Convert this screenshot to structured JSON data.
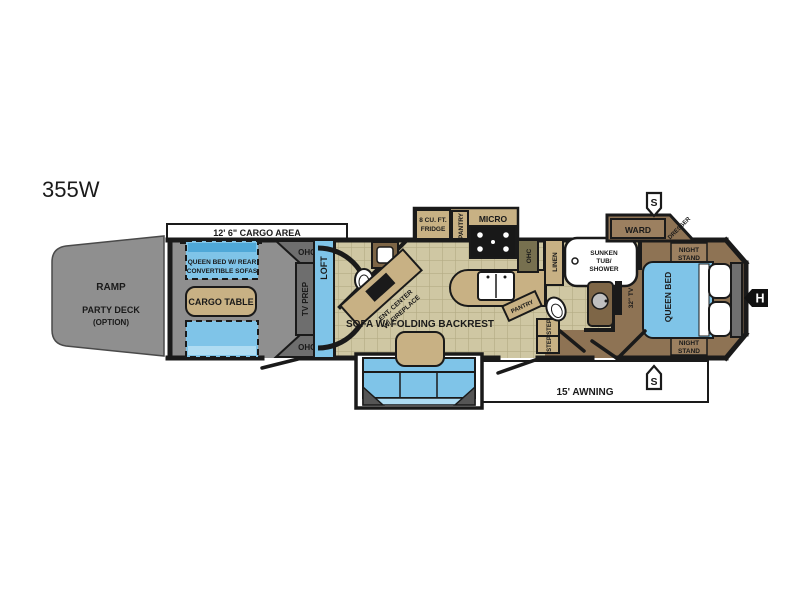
{
  "title": "355W",
  "markers": {
    "slide": "S",
    "hitch": "H"
  },
  "exterior": {
    "cargo_area": "12' 6\" CARGO AREA",
    "awning": "15' AWNING",
    "ramp": "RAMP",
    "party_deck": "PARTY DECK",
    "party_deck_option": "(OPTION)"
  },
  "garage": {
    "bed_line1": "QUEEN BED W/ REAR",
    "bed_line2": "CONVERTIBLE SOFAS",
    "cargo_table": "CARGO TABLE",
    "ohc": "OHC",
    "tv_prep": "TV PREP",
    "loft": "LOFT"
  },
  "living": {
    "ent_line1": "ENT. CENTER",
    "ent_line2": "W/ FIREPLACE",
    "sofa": "SOFA W/ FOLDING BACKREST",
    "fridge_line1": "8 CU. FT.",
    "fridge_line2": "FRIDGE",
    "pantry": "PANTRY",
    "micro": "MICRO",
    "ohc": "OHC",
    "step": "STEP"
  },
  "bath": {
    "linen": "LINEN",
    "tub_line1": "SUNKEN",
    "tub_line2": "TUB/",
    "tub_line3": "SHOWER"
  },
  "bedroom": {
    "ward": "WARD",
    "dresser": "DRESSER",
    "night_stand_line1": "NIGHT",
    "night_stand_line2": "STAND",
    "queen_bed": "QUEEN BED",
    "tv": "32\" TV"
  },
  "colors": {
    "outline": "#1a1a1a",
    "floor_tile": "#CFC7A3",
    "tile_grid": "#B4AB84",
    "floor_brown": "#8E7354",
    "floor_gray": "#8F8F8F",
    "cabinet_tan": "#C8B184",
    "wood_brown": "#7E6647",
    "furniture_blue": "#7FC4E8",
    "furniture_blue_dark": "#4FA8D8",
    "furniture_blue_light": "#AFDCF2",
    "panel_gray": "#6E6E6E",
    "white": "#FFFFFF"
  }
}
